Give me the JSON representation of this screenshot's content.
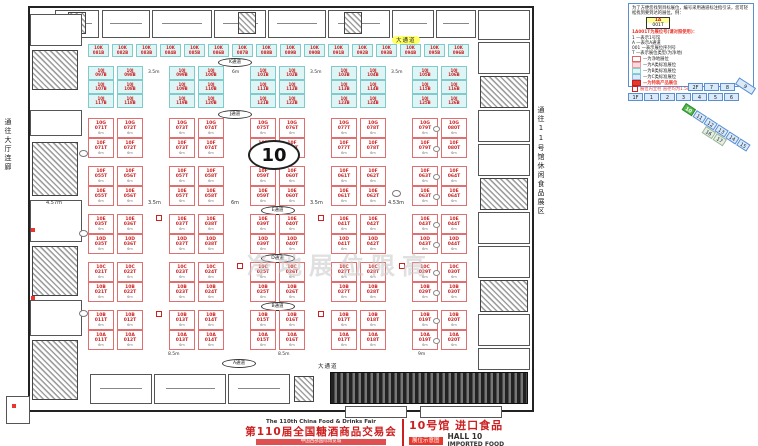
{
  "hall_number": "10",
  "watermark": "净地展位限高",
  "corridors": {
    "left": "通往大厅连廊",
    "right": "通往11号馆休闲食品展区"
  },
  "labels": {
    "main_top": "大通道",
    "main_bottom": "大通道"
  },
  "dims": {
    "small_area": [
      "3.5m",
      "6m",
      "3.5m",
      "3.5m"
    ],
    "mid": [
      "4.57m",
      "3.5m",
      "6m",
      "3.5m",
      "4.53m"
    ],
    "bottom": [
      "8.5m",
      "8.5m",
      "9m"
    ],
    "booth_depth": "6m"
  },
  "aisles_small": [
    "K通道",
    "J通道"
  ],
  "booths": {
    "top_row": [
      "10K 081B",
      "10K 082B",
      "10K 083B",
      "10K 084B",
      "10K 085B",
      "10K 086B",
      "10K 087B",
      "10K 088B",
      "10K 089B",
      "10K 090B",
      "10K 091B",
      "10K 092B",
      "10K 093B",
      "10K 094B",
      "10K 095B",
      "10K 096B"
    ],
    "block_rows": [
      [
        "10J 097B",
        "10J 098B",
        "10J 099B",
        "10J 100B",
        "10J 101B",
        "10J 102B",
        "10J 103B",
        "10J 104B",
        "10J 105B",
        "10J 106B"
      ],
      [
        "10J 107B",
        "10J 108B",
        "10J 109B",
        "10J 110B",
        "10J 111B",
        "10J 112B",
        "10J 113B",
        "10J 114B",
        "10J 115B",
        "10J 116B"
      ],
      [
        "10J 117B",
        "10J 118B",
        "10J 119B",
        "10J 120B",
        "10J 121B",
        "10J 122B",
        "10J 123B",
        "10J 124B",
        "10J 125B",
        "10J 126B"
      ]
    ]
  },
  "main_grid": {
    "rows": [
      [
        "10G 071T",
        "10G 072T",
        "10G 073T",
        "10G 074T",
        "10G 075T",
        "10G 076T",
        "10G 077T",
        "10G 078T",
        "10G 079T",
        "10G 080T"
      ],
      [
        "10F 071T",
        "10F 072T",
        "10F 073T",
        "10F 074T",
        "10F 075T",
        "10F 076T",
        "10F 077T",
        "10F 078T",
        "10F 079T",
        "10F 080T"
      ],
      [
        "10F 055T",
        "10F 056T",
        "10F 057T",
        "10F 058T",
        "10F 059T",
        "10F 060T",
        "10F 061T",
        "10F 062T",
        "10F 063T",
        "10F 064T"
      ],
      [
        "10E 055T",
        "10E 056T",
        "10E 057T",
        "10E 058T",
        "10E 059T",
        "10E 060T",
        "10E 061T",
        "10E 062T",
        "10E 063T",
        "10E 064T"
      ],
      [
        "10E 035T",
        "10E 036T",
        "10E 037T",
        "10E 038T",
        "10E 039T",
        "10E 040T",
        "10E 041T",
        "10E 042T",
        "10E 043T",
        "10E 044T"
      ],
      [
        "10D 035T",
        "10D 036T",
        "10D 037T",
        "10D 038T",
        "10D 039T",
        "10D 040T",
        "10D 041T",
        "10D 042T",
        "10D 043T",
        "10D 044T"
      ],
      [
        "10C 021T",
        "10C 022T",
        "10C 023T",
        "10C 024T",
        "10C 025T",
        "10C 026T",
        "10C 027T",
        "10C 028T",
        "10C 029T",
        "10C 030T"
      ],
      [
        "10B 021T",
        "10B 022T",
        "10B 023T",
        "10B 024T",
        "10B 025T",
        "10B 026T",
        "10B 027T",
        "10B 028T",
        "10B 029T",
        "10B 030T"
      ],
      [
        "10B 011T",
        "10B 012T",
        "10B 013T",
        "10B 014T",
        "10B 015T",
        "10B 016T",
        "10B 017T",
        "10B 018T",
        "10B 019T",
        "10B 020T"
      ],
      [
        "10A 011T",
        "10A 012T",
        "10A 013T",
        "10A 014T",
        "10A 015T",
        "10A 016T",
        "10A 017T",
        "10A 018T",
        "10A 019T",
        "10A 020T"
      ]
    ],
    "aisles_after": {
      "1": "F通道",
      "3": "E通道",
      "5": "D通道",
      "7": "B通道"
    },
    "bottom_aisle": "A通道"
  },
  "legend": {
    "intro": "为了方便您找到目标展位，编号采用通道标注指引法，您可轻松找到要到达的展位。例：",
    "example_top": "1A",
    "example_bottom": "001T",
    "subtitle": "1A001T为展位号(请对照使用)：",
    "items": [
      "1 —表示1号馆",
      "A —表示A通道",
      "001 —表示展位序列号",
      "T —表示展位类型(为净地)"
    ],
    "colors": [
      {
        "sw": "#ffffff",
        "bd": "#e06666",
        "label": "—为净地展位"
      },
      {
        "sw": "#fbdade",
        "bd": "#e8a0a8",
        "label": "—为A类标准展位"
      },
      {
        "sw": "#dff5f5",
        "bd": "#86cfcf",
        "label": "—为B类标准展位"
      },
      {
        "sw": "#dbeaf8",
        "bd": "#8fb8dd",
        "label": "—为C类标准展位"
      }
    ],
    "special": "—为特装产品展位",
    "pillar_note": "展位内立柱 直径均为1.5m"
  },
  "minimap": {
    "floor2": [
      "2F",
      "7",
      "8"
    ],
    "floor1": [
      "1F",
      "1",
      "2",
      "3",
      "4",
      "5",
      "6"
    ],
    "strip": [
      "10",
      "11",
      "12",
      "13",
      "14",
      "15"
    ],
    "current": "10",
    "box9": "9",
    "strip2": [
      "16",
      "17"
    ]
  },
  "title": {
    "fair_en": "The 110th China Food & Drinks Fair",
    "fair_cn": "第110届全国糖酒商品交易会",
    "venue": "中国西部国际博览城",
    "hall_cn": "10号馆 进口食品",
    "badge": "展位示意图",
    "hall_en1": "HALL 10",
    "hall_en2": "IMPORTED FOOD"
  }
}
